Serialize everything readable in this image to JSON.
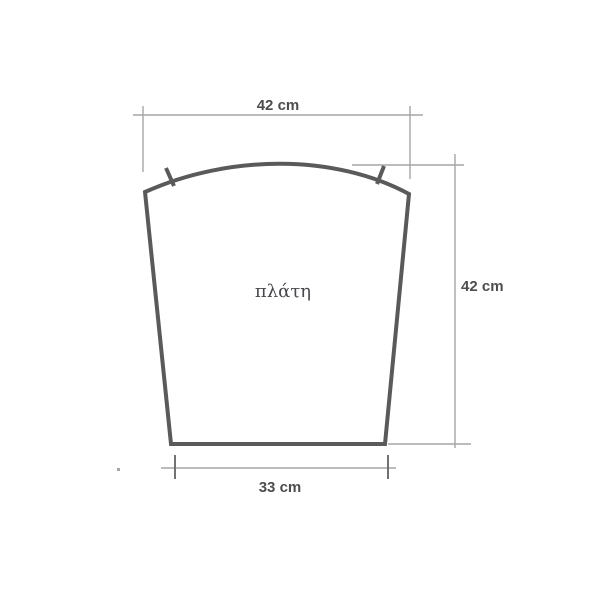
{
  "diagram": {
    "piece_label": "πλάτη",
    "dimensions": {
      "top": "42 cm",
      "right": "42 cm",
      "bottom": "33 cm"
    }
  },
  "colors": {
    "outline": "#5a5a5a",
    "dim_line": "#a6a6a6",
    "dim_tick": "#636363",
    "dim_text": "#4d4d4d",
    "label_text": "#46474f",
    "background": "#ffffff"
  }
}
